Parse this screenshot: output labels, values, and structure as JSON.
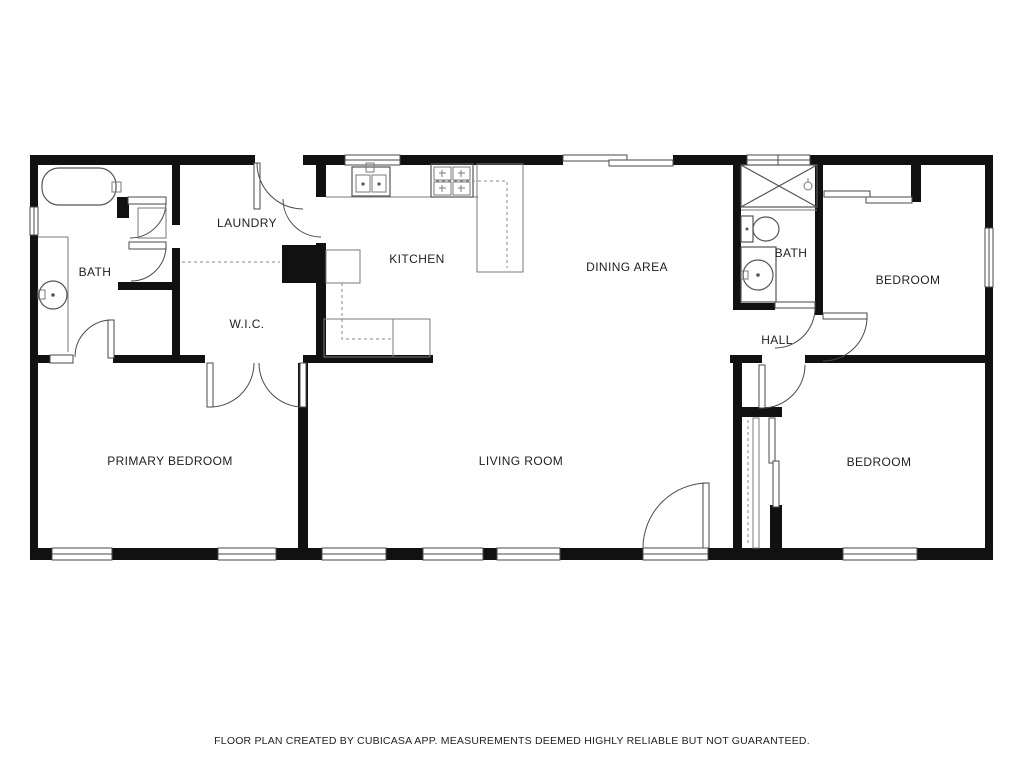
{
  "footer": {
    "disclaimer": "FLOOR PLAN CREATED BY CUBICASA APP. MEASUREMENTS DEEMED HIGHLY RELIABLE BUT NOT GUARANTEED."
  },
  "floor_plan": {
    "rooms": [
      {
        "id": "laundry",
        "label": "LAUNDRY"
      },
      {
        "id": "bath-1",
        "label": "BATH"
      },
      {
        "id": "kitchen",
        "label": "KITCHEN"
      },
      {
        "id": "dining-area",
        "label": "DINING AREA"
      },
      {
        "id": "bath-2",
        "label": "BATH"
      },
      {
        "id": "bedroom-1",
        "label": "BEDROOM"
      },
      {
        "id": "wic",
        "label": "W.I.C."
      },
      {
        "id": "hall",
        "label": "HALL"
      },
      {
        "id": "primary-bedroom",
        "label": "PRIMARY BEDROOM"
      },
      {
        "id": "living-room",
        "label": "LIVING ROOM"
      },
      {
        "id": "bedroom-2",
        "label": "BEDROOM"
      }
    ],
    "fixtures": [
      "bathtub",
      "vanity-sink",
      "washer-dryer-area",
      "kitchen-sink",
      "stove",
      "kitchen-counter",
      "shower",
      "toilet",
      "sliding-closet-doors",
      "entry-door"
    ],
    "colors": {
      "wall": "#111111",
      "fixture_line": "#555555",
      "dash_line": "#8a8a8a",
      "label_text": "#1f1f1f",
      "background": "#ffffff"
    }
  }
}
